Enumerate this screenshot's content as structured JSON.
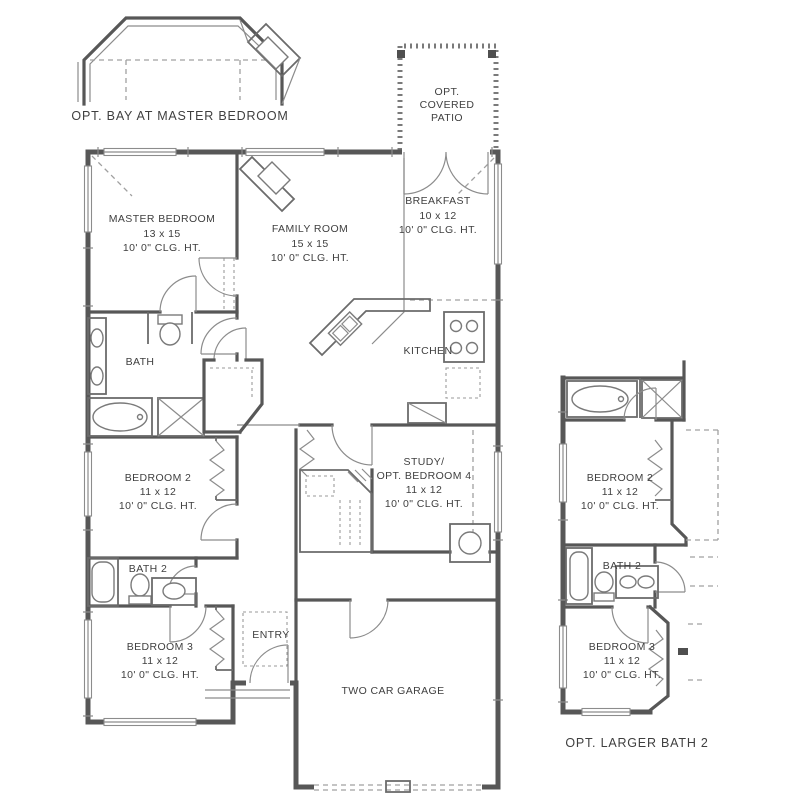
{
  "colors": {
    "wall": "#575757",
    "thin_line": "#8c8c8c",
    "dashed_line": "#a0a0a0",
    "text": "#3f3f3f",
    "background": "#ffffff"
  },
  "captions": {
    "bay": "OPT. BAY AT MASTER BEDROOM",
    "larger_bath": "OPT. LARGER BATH 2"
  },
  "patio": {
    "line1": "OPT.",
    "line2": "COVERED",
    "line3": "PATIO"
  },
  "rooms": {
    "master": {
      "name": "MASTER BEDROOM",
      "dims": "13 x 15",
      "clg": "10' 0\" CLG. HT."
    },
    "family": {
      "name": "FAMILY ROOM",
      "dims": "15 x 15",
      "clg": "10' 0\" CLG. HT."
    },
    "breakfast": {
      "name": "BREAKFAST",
      "dims": "10 x 12",
      "clg": "10' 0\" CLG. HT."
    },
    "kitchen": {
      "name": "KITCHEN"
    },
    "bath": {
      "name": "BATH"
    },
    "bedroom2": {
      "name": "BEDROOM 2",
      "dims": "11 x 12",
      "clg": "10' 0\" CLG. HT."
    },
    "bath2": {
      "name": "BATH 2"
    },
    "bedroom3": {
      "name": "BEDROOM 3",
      "dims": "11 x 12",
      "clg": "10' 0\" CLG. HT."
    },
    "study": {
      "name1": "STUDY/",
      "name2": "OPT. BEDROOM 4",
      "dims": "11 x 12",
      "clg": "10' 0\" CLG. HT."
    },
    "entry": {
      "name": "ENTRY"
    },
    "garage": {
      "name": "TWO CAR GARAGE"
    }
  },
  "inset": {
    "bedroom2": {
      "name": "BEDROOM 2",
      "dims": "11 x 12",
      "clg": "10' 0\" CLG. HT."
    },
    "bath2": {
      "name": "BATH 2"
    },
    "bedroom3": {
      "name": "BEDROOM 3",
      "dims": "11 x 12",
      "clg": "10' 0\" CLG. HT."
    }
  }
}
